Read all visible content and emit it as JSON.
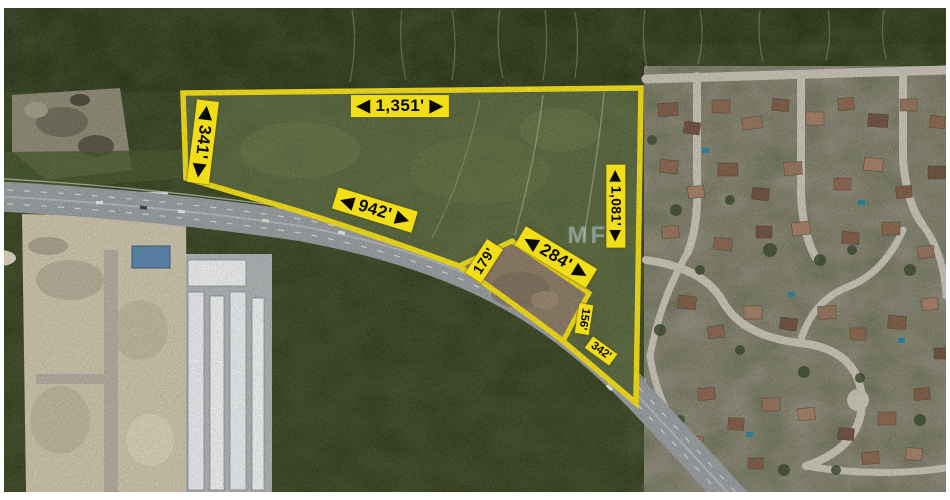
{
  "photo": {
    "type": "satellite-aerial-view"
  },
  "watermark": "MFR",
  "parcel": {
    "outline_color": "#f2de17",
    "label_bg": "#f2de17",
    "label_text_color": "#0a0a00",
    "dimensions": {
      "top": "◀ 1,351' ▶",
      "west": "◀ 341' ▶",
      "road_frontage": "◀ 942' ▶",
      "notch_west": "179'",
      "notch_north": "◀ 284' ▶",
      "east": "◀ 1,081' ▶",
      "notch_east": "156'",
      "southeast": "342'"
    }
  }
}
